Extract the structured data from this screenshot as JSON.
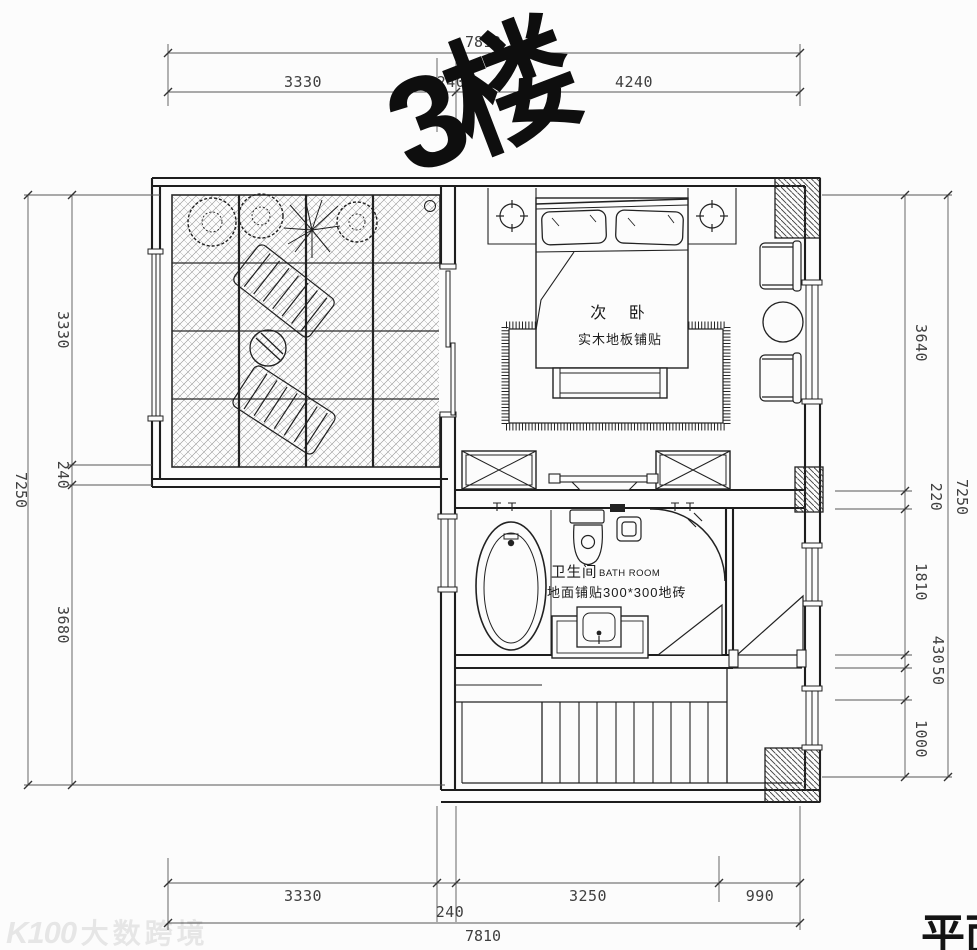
{
  "title": "3楼",
  "sheet_title_partial": "平面",
  "watermark": {
    "logo": "K100",
    "text": "大数跨境"
  },
  "rooms": {
    "bedroom": {
      "name": "次 卧",
      "floor": "实木地板铺贴"
    },
    "bathroom": {
      "name": "卫生间",
      "name_en": "BATH ROOM",
      "floor": "地面铺贴300*300地砖"
    }
  },
  "dimensions": {
    "top": {
      "overall": "7810",
      "segments": [
        "3330",
        "240",
        "4240"
      ]
    },
    "bottom": {
      "overall": "7810",
      "segments": [
        "3330",
        "240",
        "3250",
        "990"
      ]
    },
    "left": {
      "overall": "7250",
      "segments": [
        "3330",
        "240",
        "3680"
      ]
    },
    "right": {
      "overall": "7250",
      "segments": [
        "3640",
        "220",
        "1810",
        "430",
        "50",
        "1000"
      ]
    }
  },
  "colors": {
    "line": "#222222",
    "dim_text": "#3f3f3f",
    "watermark": "#e8e8e8"
  }
}
